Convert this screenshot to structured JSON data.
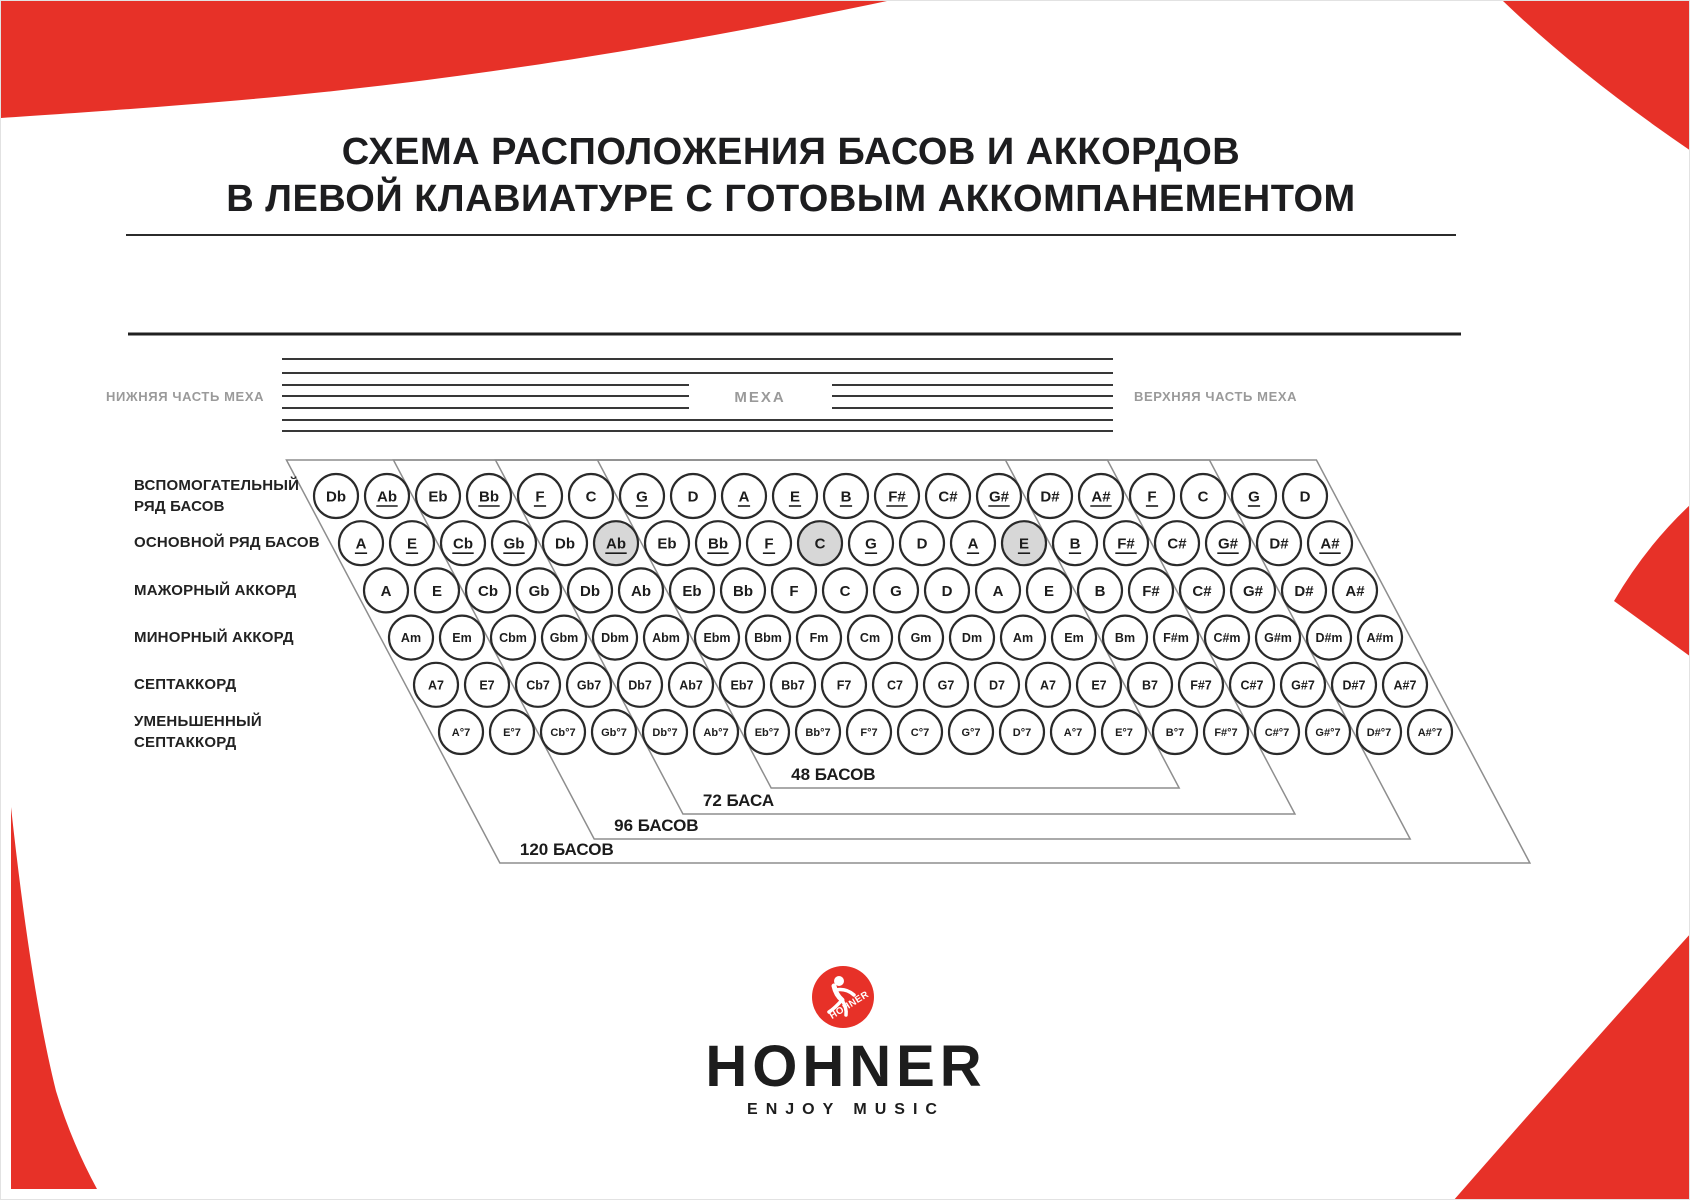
{
  "title": {
    "line1": "СХЕМА РАСПОЛОЖЕНИЯ БАСОВ И АККОРДОВ",
    "line2": "В ЛЕВОЙ КЛАВИАТУРЕ С ГОТОВЫМ АККОМПАНЕМЕНТОМ",
    "full": "СХЕМА РАСПОЛОЖЕНИЯ БАСОВ И АККОРДОВ\nВ ЛЕВОЙ КЛАВИАТУРЕ С ГОТОВЫМ АККОМПАНЕМЕНТОМ"
  },
  "bellows": {
    "left_label": "НИЖНЯЯ ЧАСТЬ МЕХА",
    "center_label": "МЕХА",
    "right_label": "ВЕРХНЯЯ ЧАСТЬ МЕХА"
  },
  "rows": [
    {
      "id": "aux-bass-row",
      "label": "ВСПОМОГАТЕЛЬНЫЙ\nРЯД БАСОВ",
      "buttons": [
        {
          "t": "Db"
        },
        {
          "t": "Ab",
          "u": true
        },
        {
          "t": "Eb"
        },
        {
          "t": "Bb",
          "u": true
        },
        {
          "t": "F",
          "u": true
        },
        {
          "t": "C"
        },
        {
          "t": "G",
          "u": true
        },
        {
          "t": "D"
        },
        {
          "t": "A",
          "u": true
        },
        {
          "t": "E",
          "u": true
        },
        {
          "t": "B",
          "u": true
        },
        {
          "t": "F#",
          "u": true
        },
        {
          "t": "C#"
        },
        {
          "t": "G#",
          "u": true
        },
        {
          "t": "D#"
        },
        {
          "t": "A#",
          "u": true
        },
        {
          "t": "F",
          "u": true
        },
        {
          "t": "C"
        },
        {
          "t": "G",
          "u": true
        },
        {
          "t": "D"
        }
      ]
    },
    {
      "id": "main-bass-row",
      "label": "ОСНОВНОЙ РЯД БАСОВ",
      "buttons": [
        {
          "t": "A",
          "u": true
        },
        {
          "t": "E",
          "u": true
        },
        {
          "t": "Cb",
          "u": true
        },
        {
          "t": "Gb",
          "u": true
        },
        {
          "t": "Db"
        },
        {
          "t": "Ab",
          "u": true,
          "g": true
        },
        {
          "t": "Eb"
        },
        {
          "t": "Bb",
          "u": true
        },
        {
          "t": "F",
          "u": true
        },
        {
          "t": "C",
          "g": true
        },
        {
          "t": "G",
          "u": true
        },
        {
          "t": "D"
        },
        {
          "t": "A",
          "u": true
        },
        {
          "t": "E",
          "u": true,
          "g": true
        },
        {
          "t": "B",
          "u": true
        },
        {
          "t": "F#",
          "u": true
        },
        {
          "t": "C#"
        },
        {
          "t": "G#",
          "u": true
        },
        {
          "t": "D#"
        },
        {
          "t": "A#",
          "u": true
        }
      ]
    },
    {
      "id": "major-chord-row",
      "label": "МАЖОРНЫЙ АККОРД",
      "buttons": [
        {
          "t": "A"
        },
        {
          "t": "E"
        },
        {
          "t": "Cb"
        },
        {
          "t": "Gb"
        },
        {
          "t": "Db"
        },
        {
          "t": "Ab"
        },
        {
          "t": "Eb"
        },
        {
          "t": "Bb"
        },
        {
          "t": "F"
        },
        {
          "t": "C"
        },
        {
          "t": "G"
        },
        {
          "t": "D"
        },
        {
          "t": "A"
        },
        {
          "t": "E"
        },
        {
          "t": "B"
        },
        {
          "t": "F#"
        },
        {
          "t": "C#"
        },
        {
          "t": "G#"
        },
        {
          "t": "D#"
        },
        {
          "t": "A#"
        }
      ]
    },
    {
      "id": "minor-chord-row",
      "label": "МИНОРНЫЙ АККОРД",
      "buttons": [
        {
          "t": "Am"
        },
        {
          "t": "Em"
        },
        {
          "t": "Cbm"
        },
        {
          "t": "Gbm"
        },
        {
          "t": "Dbm"
        },
        {
          "t": "Abm"
        },
        {
          "t": "Ebm"
        },
        {
          "t": "Bbm"
        },
        {
          "t": "Fm"
        },
        {
          "t": "Cm"
        },
        {
          "t": "Gm"
        },
        {
          "t": "Dm"
        },
        {
          "t": "Am"
        },
        {
          "t": "Em"
        },
        {
          "t": "Bm"
        },
        {
          "t": "F#m"
        },
        {
          "t": "C#m"
        },
        {
          "t": "G#m"
        },
        {
          "t": "D#m"
        },
        {
          "t": "A#m"
        }
      ]
    },
    {
      "id": "seventh-chord-row",
      "label": "СЕПТАККОРД",
      "buttons": [
        {
          "t": "A7"
        },
        {
          "t": "E7"
        },
        {
          "t": "Cb7"
        },
        {
          "t": "Gb7"
        },
        {
          "t": "Db7"
        },
        {
          "t": "Ab7"
        },
        {
          "t": "Eb7"
        },
        {
          "t": "Bb7"
        },
        {
          "t": "F7"
        },
        {
          "t": "C7"
        },
        {
          "t": "G7"
        },
        {
          "t": "D7"
        },
        {
          "t": "A7"
        },
        {
          "t": "E7"
        },
        {
          "t": "B7"
        },
        {
          "t": "F#7"
        },
        {
          "t": "C#7"
        },
        {
          "t": "G#7"
        },
        {
          "t": "D#7"
        },
        {
          "t": "A#7"
        }
      ]
    },
    {
      "id": "diminished-seventh-row",
      "label": "УМЕНЬШЕННЫЙ\nСЕПТАККОРД",
      "buttons": [
        {
          "t": "A°7"
        },
        {
          "t": "E°7"
        },
        {
          "t": "Cb°7"
        },
        {
          "t": "Gb°7"
        },
        {
          "t": "Db°7"
        },
        {
          "t": "Ab°7"
        },
        {
          "t": "Eb°7"
        },
        {
          "t": "Bb°7"
        },
        {
          "t": "F°7"
        },
        {
          "t": "C°7"
        },
        {
          "t": "G°7"
        },
        {
          "t": "D°7"
        },
        {
          "t": "A°7"
        },
        {
          "t": "E°7"
        },
        {
          "t": "B°7"
        },
        {
          "t": "F#°7"
        },
        {
          "t": "C#°7"
        },
        {
          "t": "G#°7"
        },
        {
          "t": "D#°7"
        },
        {
          "t": "A#°7"
        }
      ]
    }
  ],
  "sections": [
    {
      "label": "48 БАСОВ"
    },
    {
      "label": "72 БАСА"
    },
    {
      "label": "96 БАСОВ"
    },
    {
      "label": "120 БАСОВ"
    }
  ],
  "logo": {
    "badge_text": "HOHNER",
    "brand": "HOHNER",
    "tagline": "ENJOY MUSIC"
  },
  "colors": {
    "accent_red": "#e73128",
    "button_stroke": "#2a2a2a",
    "shaded_button_fill": "#d7d7d7",
    "section_line": "#8e8e8e",
    "bellows_line": "#383838",
    "muted_label": "#9a9a9a",
    "text_dark": "#1d1d1d"
  }
}
